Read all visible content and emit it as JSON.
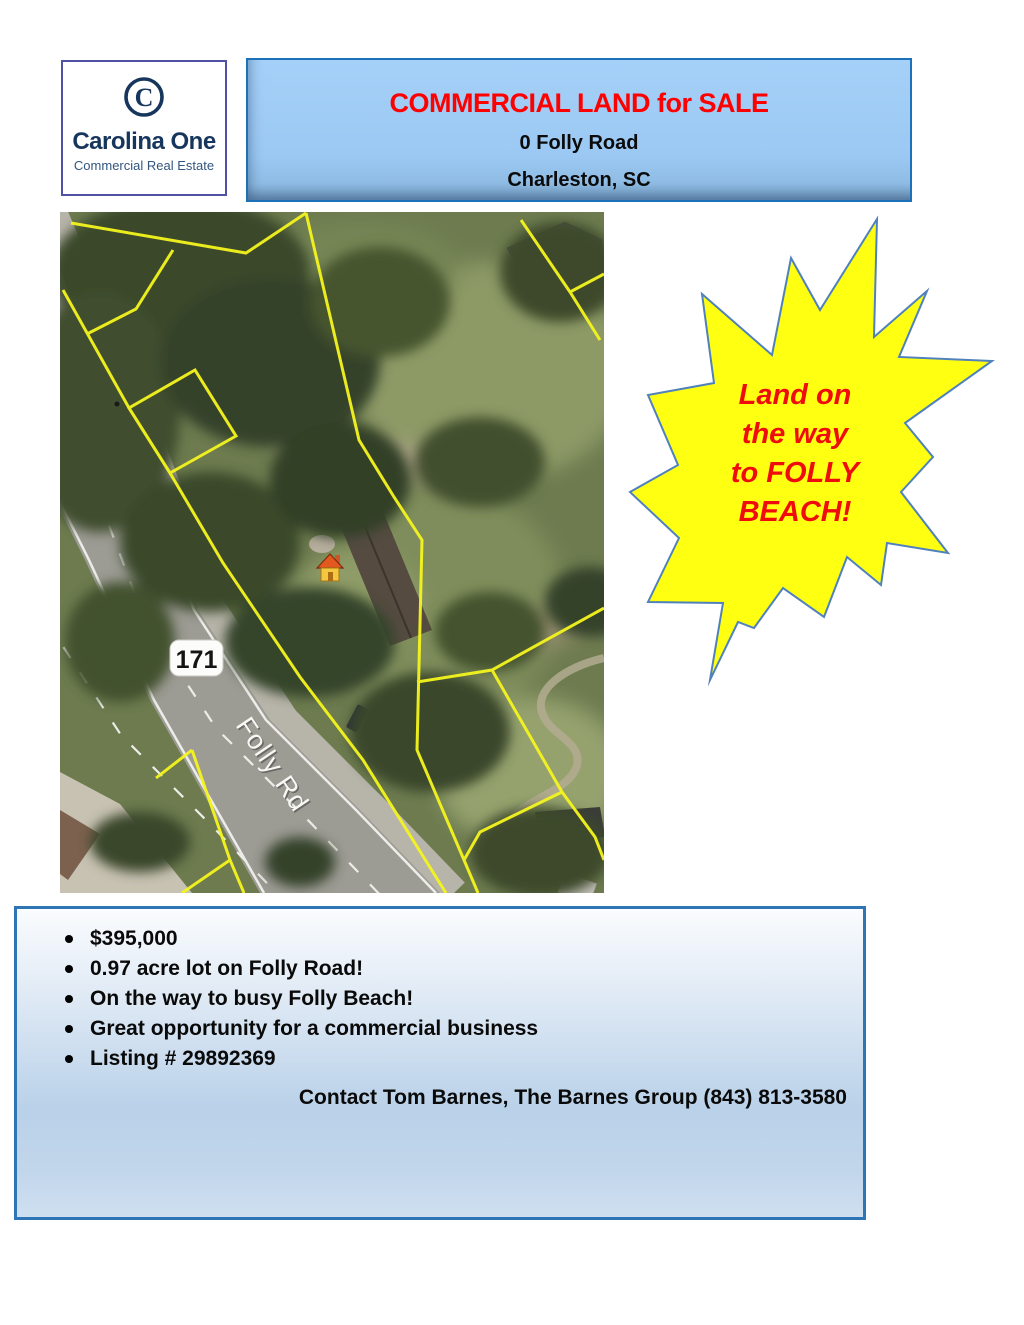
{
  "logo": {
    "icon_letter": "C",
    "name": "Carolina One",
    "tagline": "Commercial Real Estate",
    "text_color": "#17365d",
    "border_color": "#5151a3"
  },
  "header": {
    "title": "COMMERCIAL LAND for SALE",
    "address_line1": "0 Folly Road",
    "address_line2": "Charleston, SC",
    "title_color": "#ff0000",
    "background": "#9cc9f4",
    "border_color": "#1d71b8"
  },
  "map": {
    "route_shield": "171",
    "road_label": "Folly Rd",
    "parcel_line_color": "#f5f51e"
  },
  "starburst": {
    "lines": [
      "Land on",
      "the way",
      "to FOLLY",
      "BEACH!"
    ],
    "fill": "#ffff12",
    "border_color": "#4f81bd",
    "text_color": "#ee0c0c"
  },
  "details": {
    "bullets": [
      "$395,000",
      "0.97 acre lot on Folly Road!",
      "On the way to busy Folly Beach!",
      "Great opportunity for a commercial business",
      "Listing # 29892369"
    ],
    "contact": "Contact Tom Barnes, The Barnes Group (843) 813-3580",
    "border_color": "#2e75b6"
  }
}
